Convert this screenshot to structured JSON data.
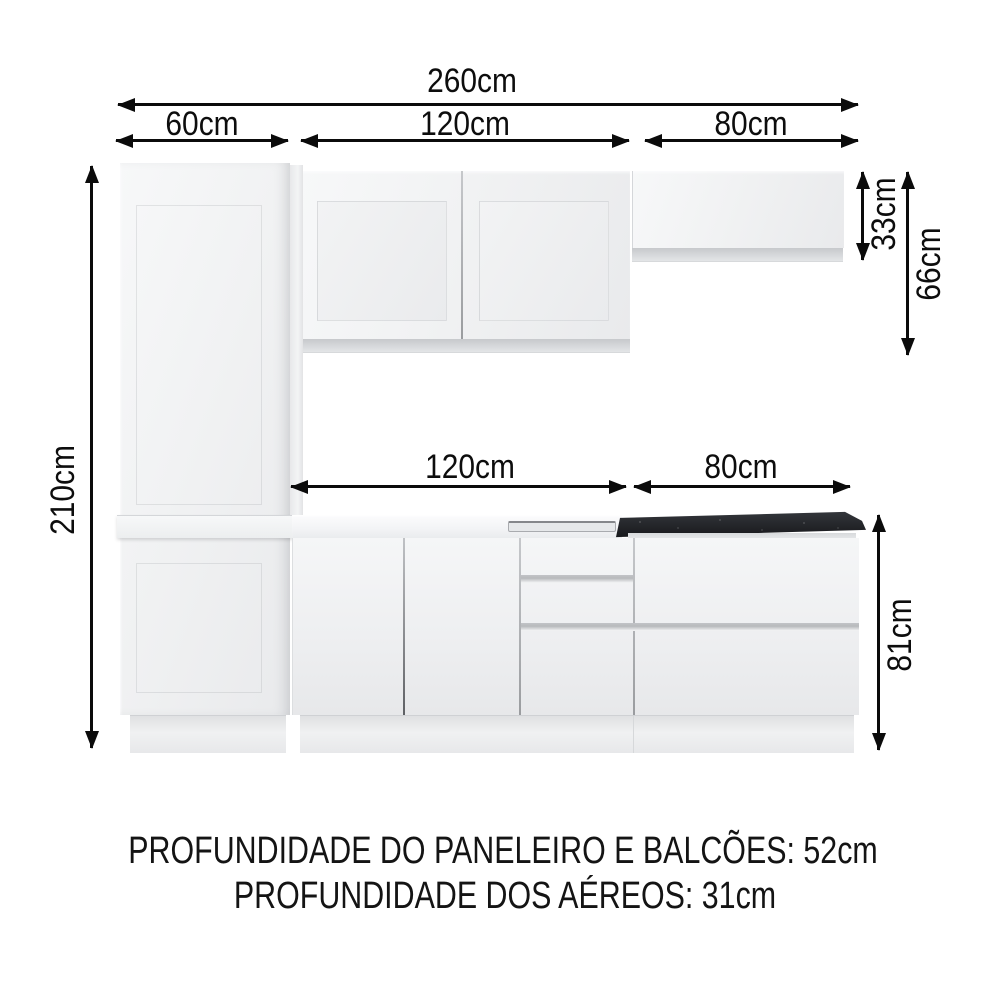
{
  "dimensions": {
    "total_width": "260cm",
    "pantry_width": "60cm",
    "upper_middle_width": "120cm",
    "upper_right_width": "80cm",
    "total_height": "210cm",
    "upper_right_height": "33cm",
    "upper_middle_height": "66cm",
    "counter_middle_width": "120cm",
    "counter_right_width": "80cm",
    "counter_height": "81cm"
  },
  "footer": {
    "line1": "PROFUNDIDADE DO PANELEIRO E BALCÕES: 52cm",
    "line2": "PROFUNDIDADE DOS AÉREOS: 31cm"
  },
  "colors": {
    "arrow": "#0b0b0b",
    "text": "#141414",
    "cabinet_light": "#f4f5f6",
    "cabinet_shadow": "#c9cbce",
    "granite_dark": "#26282c",
    "background": "#ffffff"
  }
}
